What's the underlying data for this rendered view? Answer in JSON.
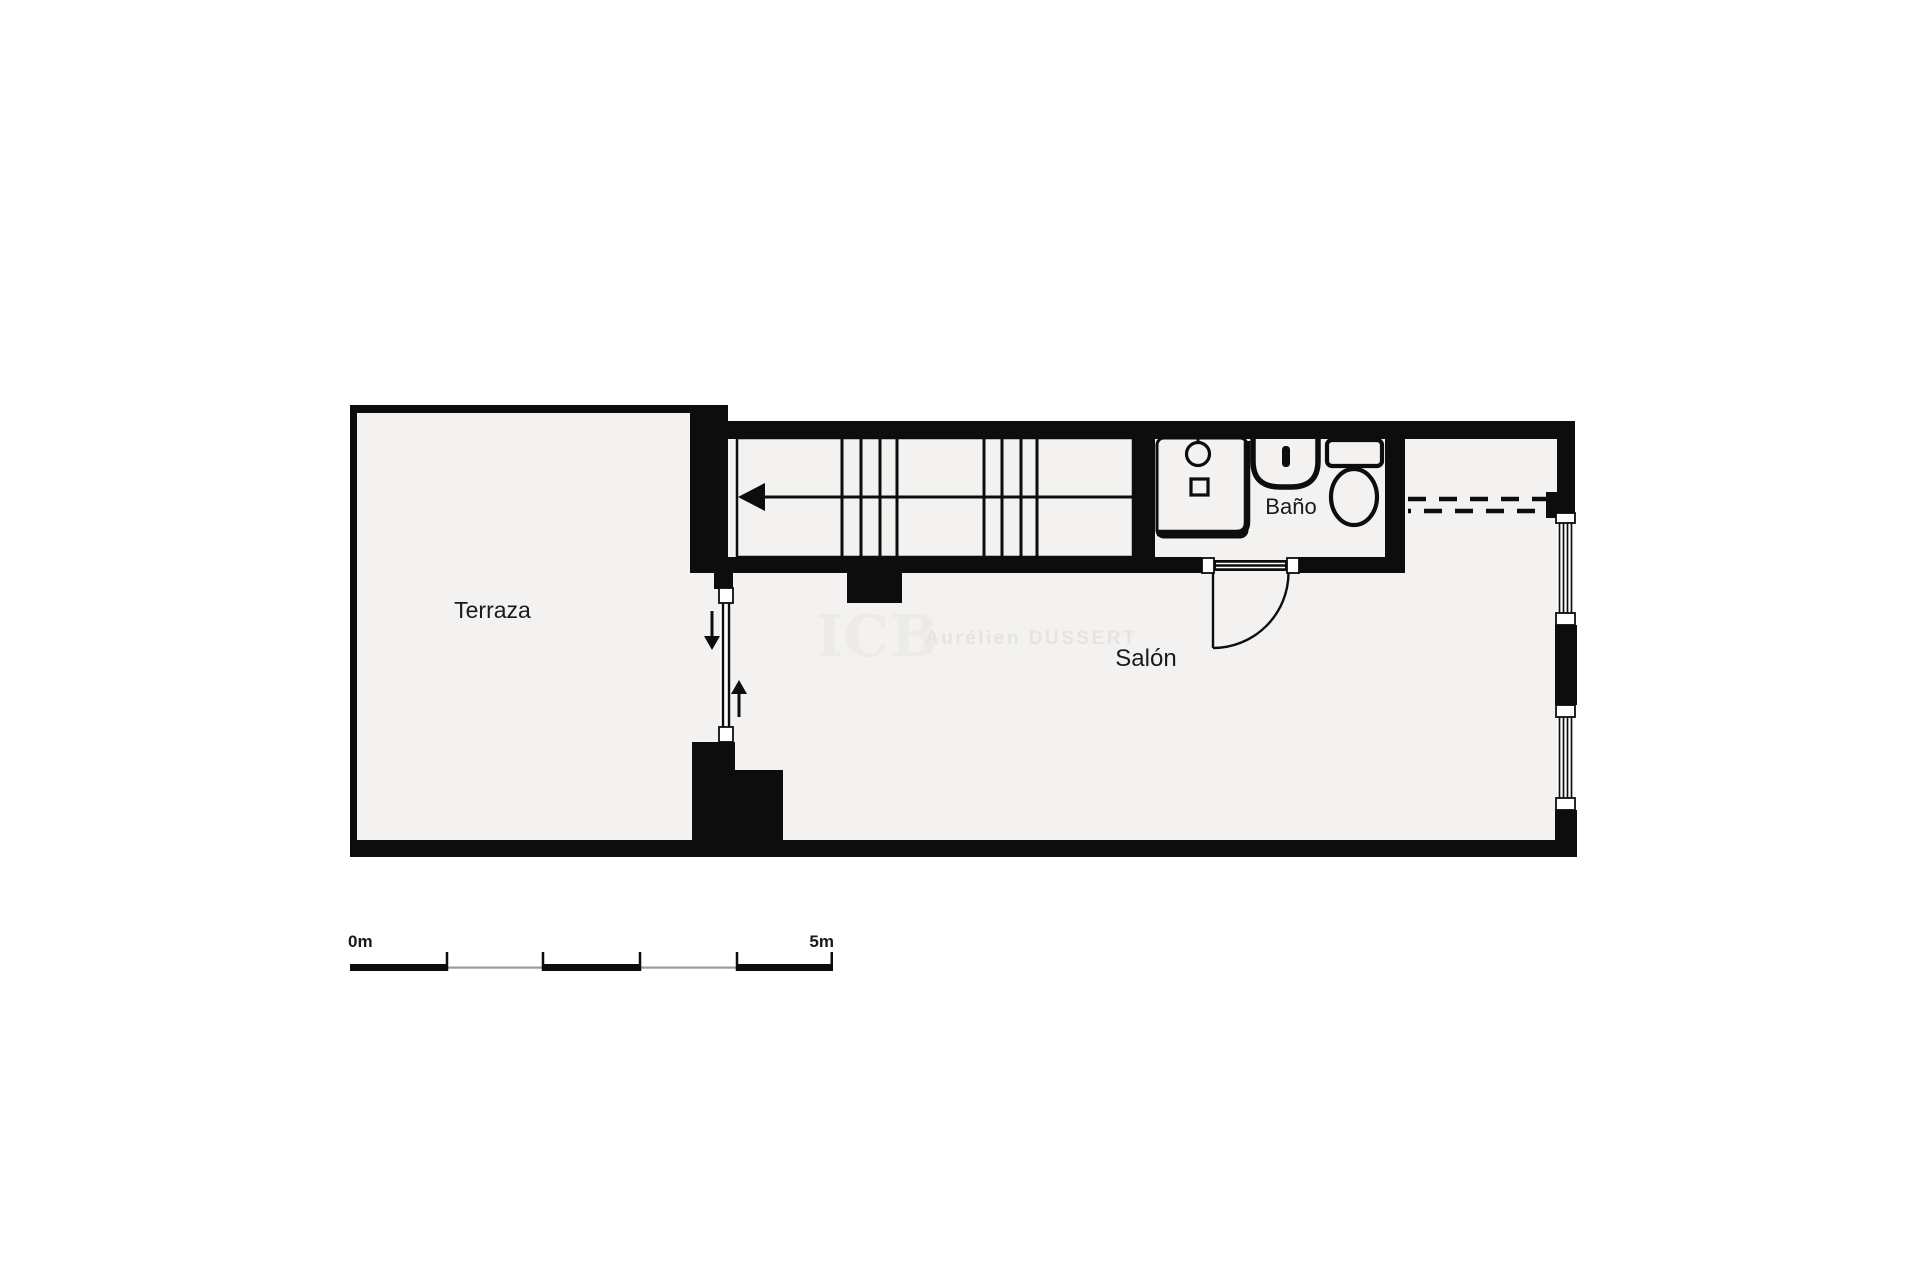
{
  "colors": {
    "wall": "#0d0d0d",
    "floor": "#f3f2f1",
    "bg": "#ffffff",
    "scale_grey": "#9b9b9b",
    "label": "#1a1a1a",
    "watermark_logo": "#edebe9",
    "watermark_name": "#e6e4e2"
  },
  "rooms": {
    "terraza": "Terraza",
    "salon": "Salón",
    "bano": "Baño"
  },
  "watermark": {
    "logo": "ICB",
    "name": "Aurélien DUSSERT"
  },
  "scale_bar": {
    "start": "0m",
    "end": "5m"
  },
  "fixtures": [
    "staircase-icon",
    "stair-direction-arrow-icon",
    "shower-icon",
    "shower-drain-icon",
    "sink-icon",
    "tap-icon",
    "toilet-icon",
    "door-swing-icon",
    "terrace-window-icon",
    "window-exit-arrows-icon",
    "facade-window-icon",
    "overhead-dashed-line-icon"
  ]
}
